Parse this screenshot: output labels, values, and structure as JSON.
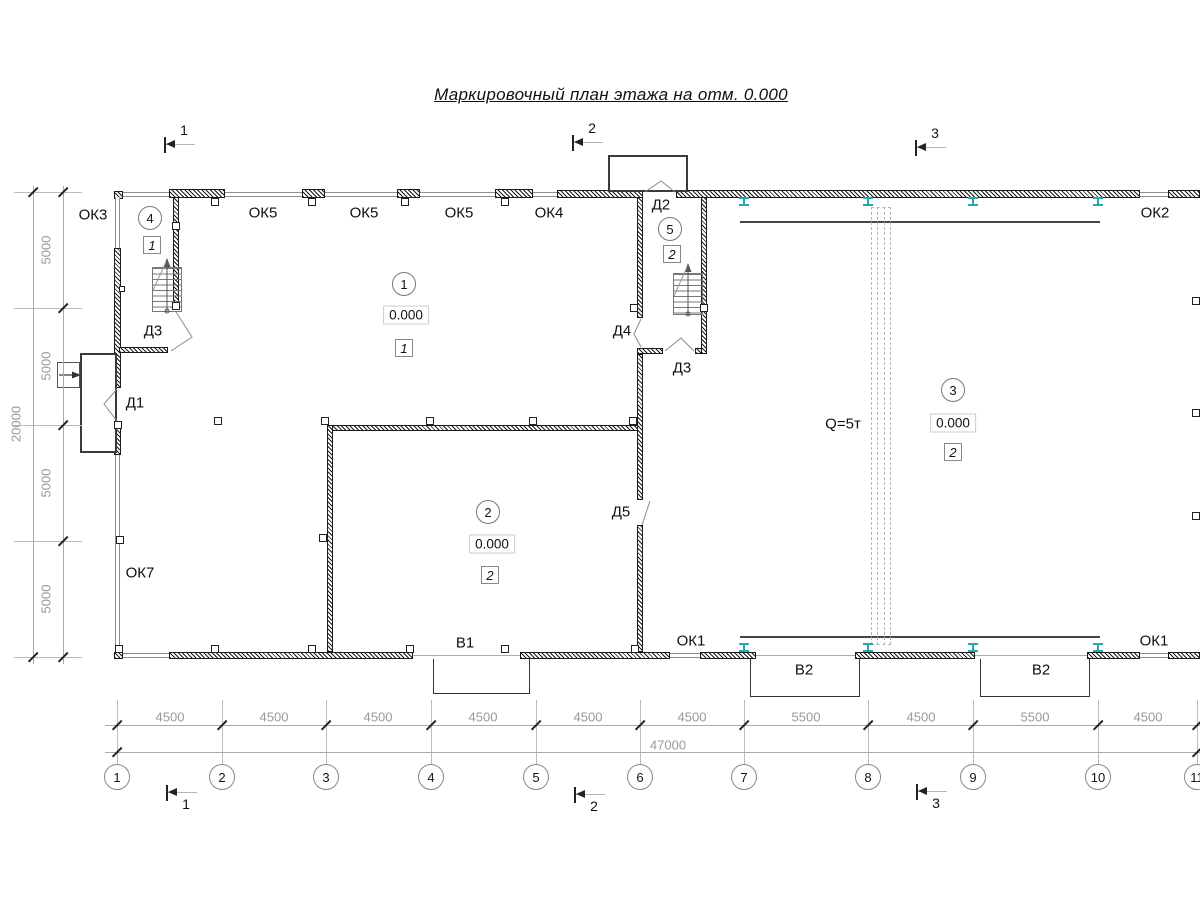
{
  "title": "Маркировочный план этажа на отм. 0.000",
  "sections": {
    "s1": "1",
    "s2": "2",
    "s3": "3"
  },
  "windows": {
    "ok3": "ОК3",
    "ok5_1": "ОК5",
    "ok5_2": "ОК5",
    "ok5_3": "ОК5",
    "ok4": "ОК4",
    "ok2": "ОК2",
    "ok7": "ОК7",
    "ok1_1": "ОК1",
    "ok1_2": "ОК1"
  },
  "doors": {
    "d1": "Д1",
    "d2": "Д2",
    "d3_1": "Д3",
    "d3_2": "Д3",
    "d4": "Д4",
    "d5": "Д5"
  },
  "gates": {
    "v1": "В1",
    "v2_1": "В2",
    "v2_2": "В2"
  },
  "crane": {
    "capacity": "Q=5т"
  },
  "rooms": {
    "r1": {
      "num": "1",
      "elev": "0.000",
      "type": "1"
    },
    "r2": {
      "num": "2",
      "elev": "0.000",
      "type": "2"
    },
    "r3": {
      "num": "3",
      "elev": "0.000",
      "type": "2"
    },
    "r4": {
      "num": "4",
      "type": "1"
    },
    "r5": {
      "num": "5",
      "type": "2"
    }
  },
  "dims": {
    "left": {
      "seg1": "5000",
      "seg2": "5000",
      "seg3": "5000",
      "seg4": "5000",
      "total": "20000"
    },
    "bottom": {
      "seg1": "4500",
      "seg2": "4500",
      "seg3": "4500",
      "seg4": "4500",
      "seg5": "4500",
      "seg6": "4500",
      "seg7": "5500",
      "seg8": "4500",
      "seg9": "5500",
      "seg10": "4500",
      "total": "47000"
    }
  },
  "axes": {
    "a1": "1",
    "a2": "2",
    "a3": "3",
    "a4": "4",
    "a5": "5",
    "a6": "6",
    "a7": "7",
    "a8": "8",
    "a9": "9",
    "a10": "10",
    "a11": "11"
  }
}
